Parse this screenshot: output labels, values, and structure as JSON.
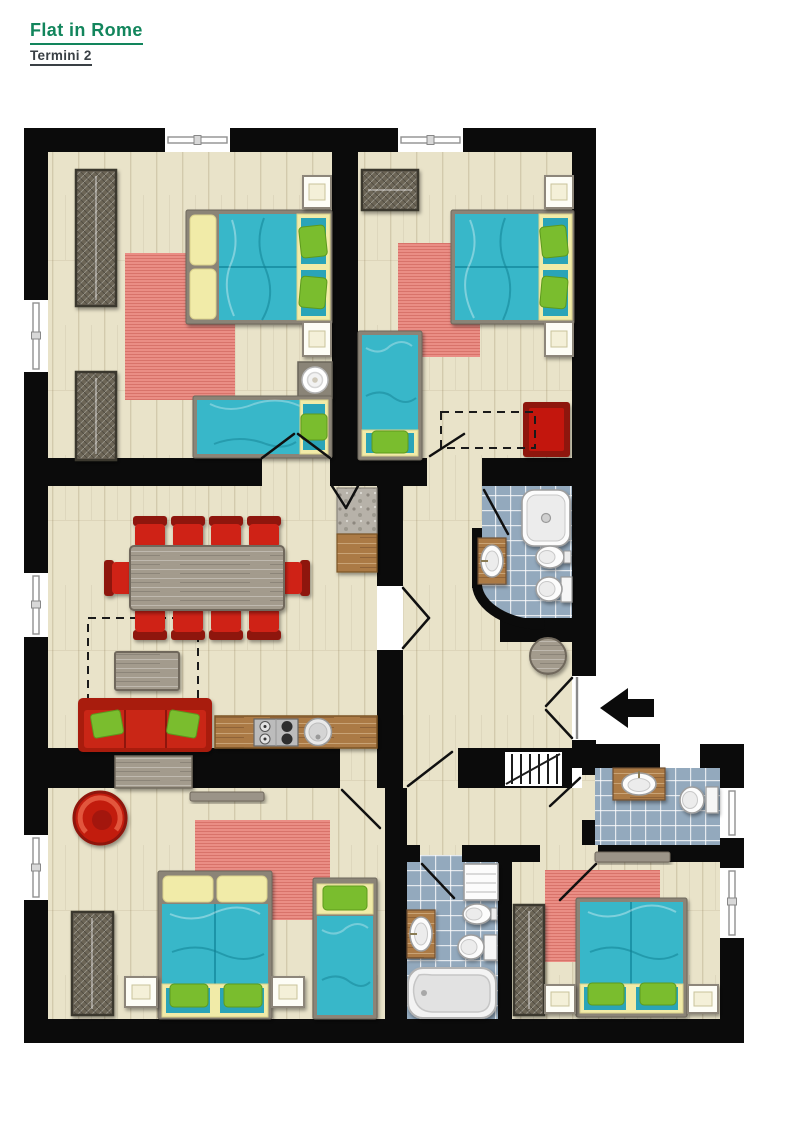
{
  "page": {
    "title": "Flat in Rome",
    "subtitle": "Termini 2"
  },
  "colors": {
    "title_green": "#12855c",
    "subtitle_dark": "#3a4045",
    "wall": "#0b0b0b",
    "floor_wood": "#e9e3c9",
    "bath_tile_blue": "#93a9bd",
    "bed_teal": "#39b7c9",
    "bed_teal_dark": "#2ba4b8",
    "bed_yellow": "#f1eba8",
    "pillow_green": "#7abd2f",
    "rug_salmon": "#ea8e85",
    "sofa_red": "#c92517",
    "chair_red": "#cf2318",
    "wood_gray": "#a39b8d",
    "wood_brown": "#ab7a45",
    "wardrobe_dark": "#6c6557",
    "granite_gray": "#b7b2a9",
    "fixture_white": "#fcfcfc"
  },
  "plan": {
    "entrance": {
      "symbol": "black-arrow-pointing-left",
      "location": "right-wall-middle"
    },
    "rooms": [
      {
        "name": "bedroom-top-left",
        "furniture": [
          "double-bed",
          "single-bed",
          "wardrobe",
          "wardrobe",
          "nightstand",
          "nightstand",
          "fan",
          "rug"
        ]
      },
      {
        "name": "bedroom-top-right",
        "furniture": [
          "double-bed",
          "single-bed",
          "wardrobe",
          "nightstand",
          "nightstand",
          "armchair-square",
          "rug",
          "dashed-area"
        ]
      },
      {
        "name": "living-dining-kitchen",
        "furniture": [
          "dining-table",
          "dining-chairs-x10",
          "sofa",
          "coffee-table",
          "kitchen-counter",
          "stove",
          "kitchen-sink",
          "corner-counter",
          "dashed-area"
        ]
      },
      {
        "name": "bathroom-middle",
        "furniture": [
          "shower",
          "washbasin",
          "bidet",
          "toilet"
        ]
      },
      {
        "name": "hallway",
        "furniture": [
          "round-stool",
          "stairs-niche"
        ]
      },
      {
        "name": "bedroom-bottom-left",
        "furniture": [
          "double-bed",
          "single-bed",
          "wardrobe",
          "nightstand",
          "nightstand",
          "round-armchair",
          "sideboard",
          "shelf",
          "rug"
        ]
      },
      {
        "name": "bathroom-bottom",
        "furniture": [
          "bathtub",
          "washbasin",
          "bidet",
          "toilet",
          "cabinet"
        ]
      },
      {
        "name": "bathroom-small-right",
        "furniture": [
          "washbasin",
          "toilet"
        ]
      },
      {
        "name": "bedroom-bottom-right",
        "furniture": [
          "double-bed",
          "wardrobe",
          "nightstand",
          "nightstand",
          "shelf",
          "rug"
        ]
      }
    ],
    "windows": 9
  }
}
